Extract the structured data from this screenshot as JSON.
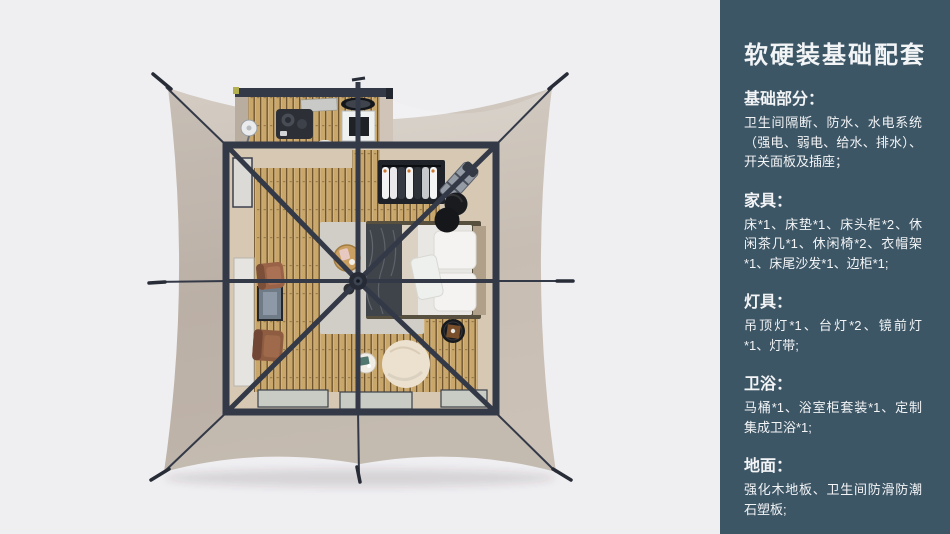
{
  "panel": {
    "title": "软硬装基础配套",
    "sections": [
      {
        "heading": "基础部分：",
        "body": "卫生间隔断、防水、水电系统（强电、弱电、给水、排水）、开关面板及插座；"
      },
      {
        "heading": "家具：",
        "body": "床*1、床垫*1、床头柜*2、休闲茶几*1、休闲椅*2、衣帽架*1、床尾沙发*1、边柜*1;"
      },
      {
        "heading": "灯具：",
        "body": "吊顶灯*1、台灯*2、镜前灯*1、灯带;"
      },
      {
        "heading": "卫浴：",
        "body": "马桶*1、浴室柜套装*1、定制集成卫浴*1;"
      },
      {
        "heading": "地面：",
        "body": "强化木地板、卫生间防滑防潮石塑板;"
      }
    ]
  },
  "theme": {
    "page-bg": "#efeff2",
    "panel-bg": "#3d5666",
    "panel-text": "#f2f4f6",
    "canvas": "#c7bdb3",
    "frame": "#333947",
    "frame-dark": "#272c37",
    "wood": "#c9a76b",
    "wood-gap": "#70552f",
    "beige": "#d6c8b3",
    "glass": "#c9ccc4",
    "rug": "#d1cec7",
    "duvet": "#e9e7e3",
    "throw": "#3f434a",
    "pillow": "#f4f3f1",
    "cream": "#ece1cf"
  }
}
